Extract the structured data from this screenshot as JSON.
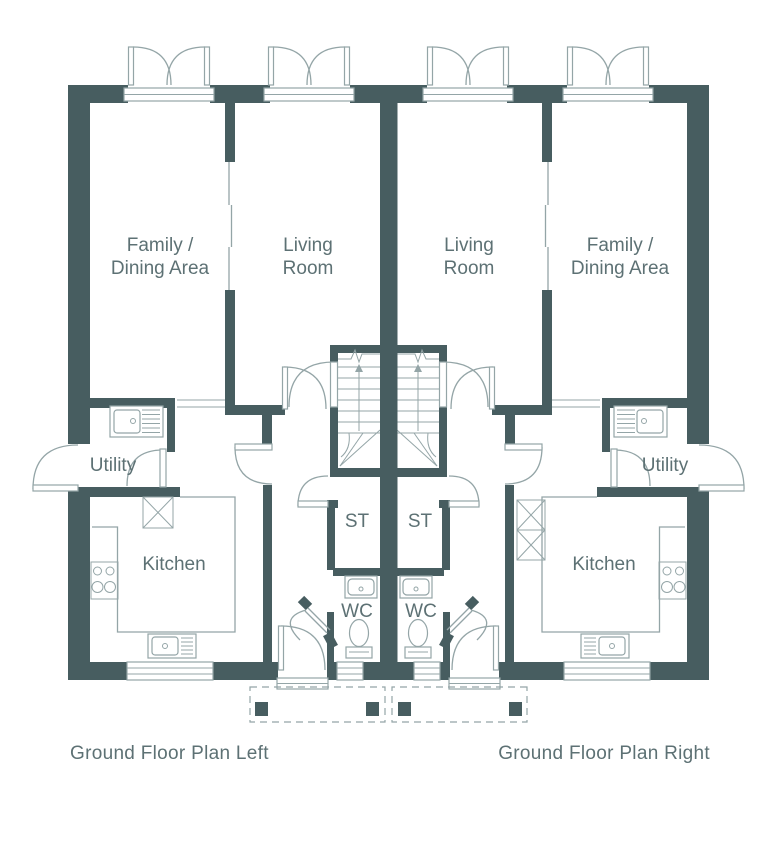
{
  "colors": {
    "wall": "#475d60",
    "line": "#94a5a7",
    "text": "#5d7174"
  },
  "rooms": {
    "family_dining": [
      "Family /",
      "Dining Area"
    ],
    "living": [
      "Living",
      "Room"
    ],
    "utility": "Utility",
    "kitchen": "Kitchen",
    "storage": "ST",
    "wc": "WC"
  },
  "captions": {
    "left": "Ground Floor Plan Left",
    "right": "Ground Floor Plan Right"
  }
}
